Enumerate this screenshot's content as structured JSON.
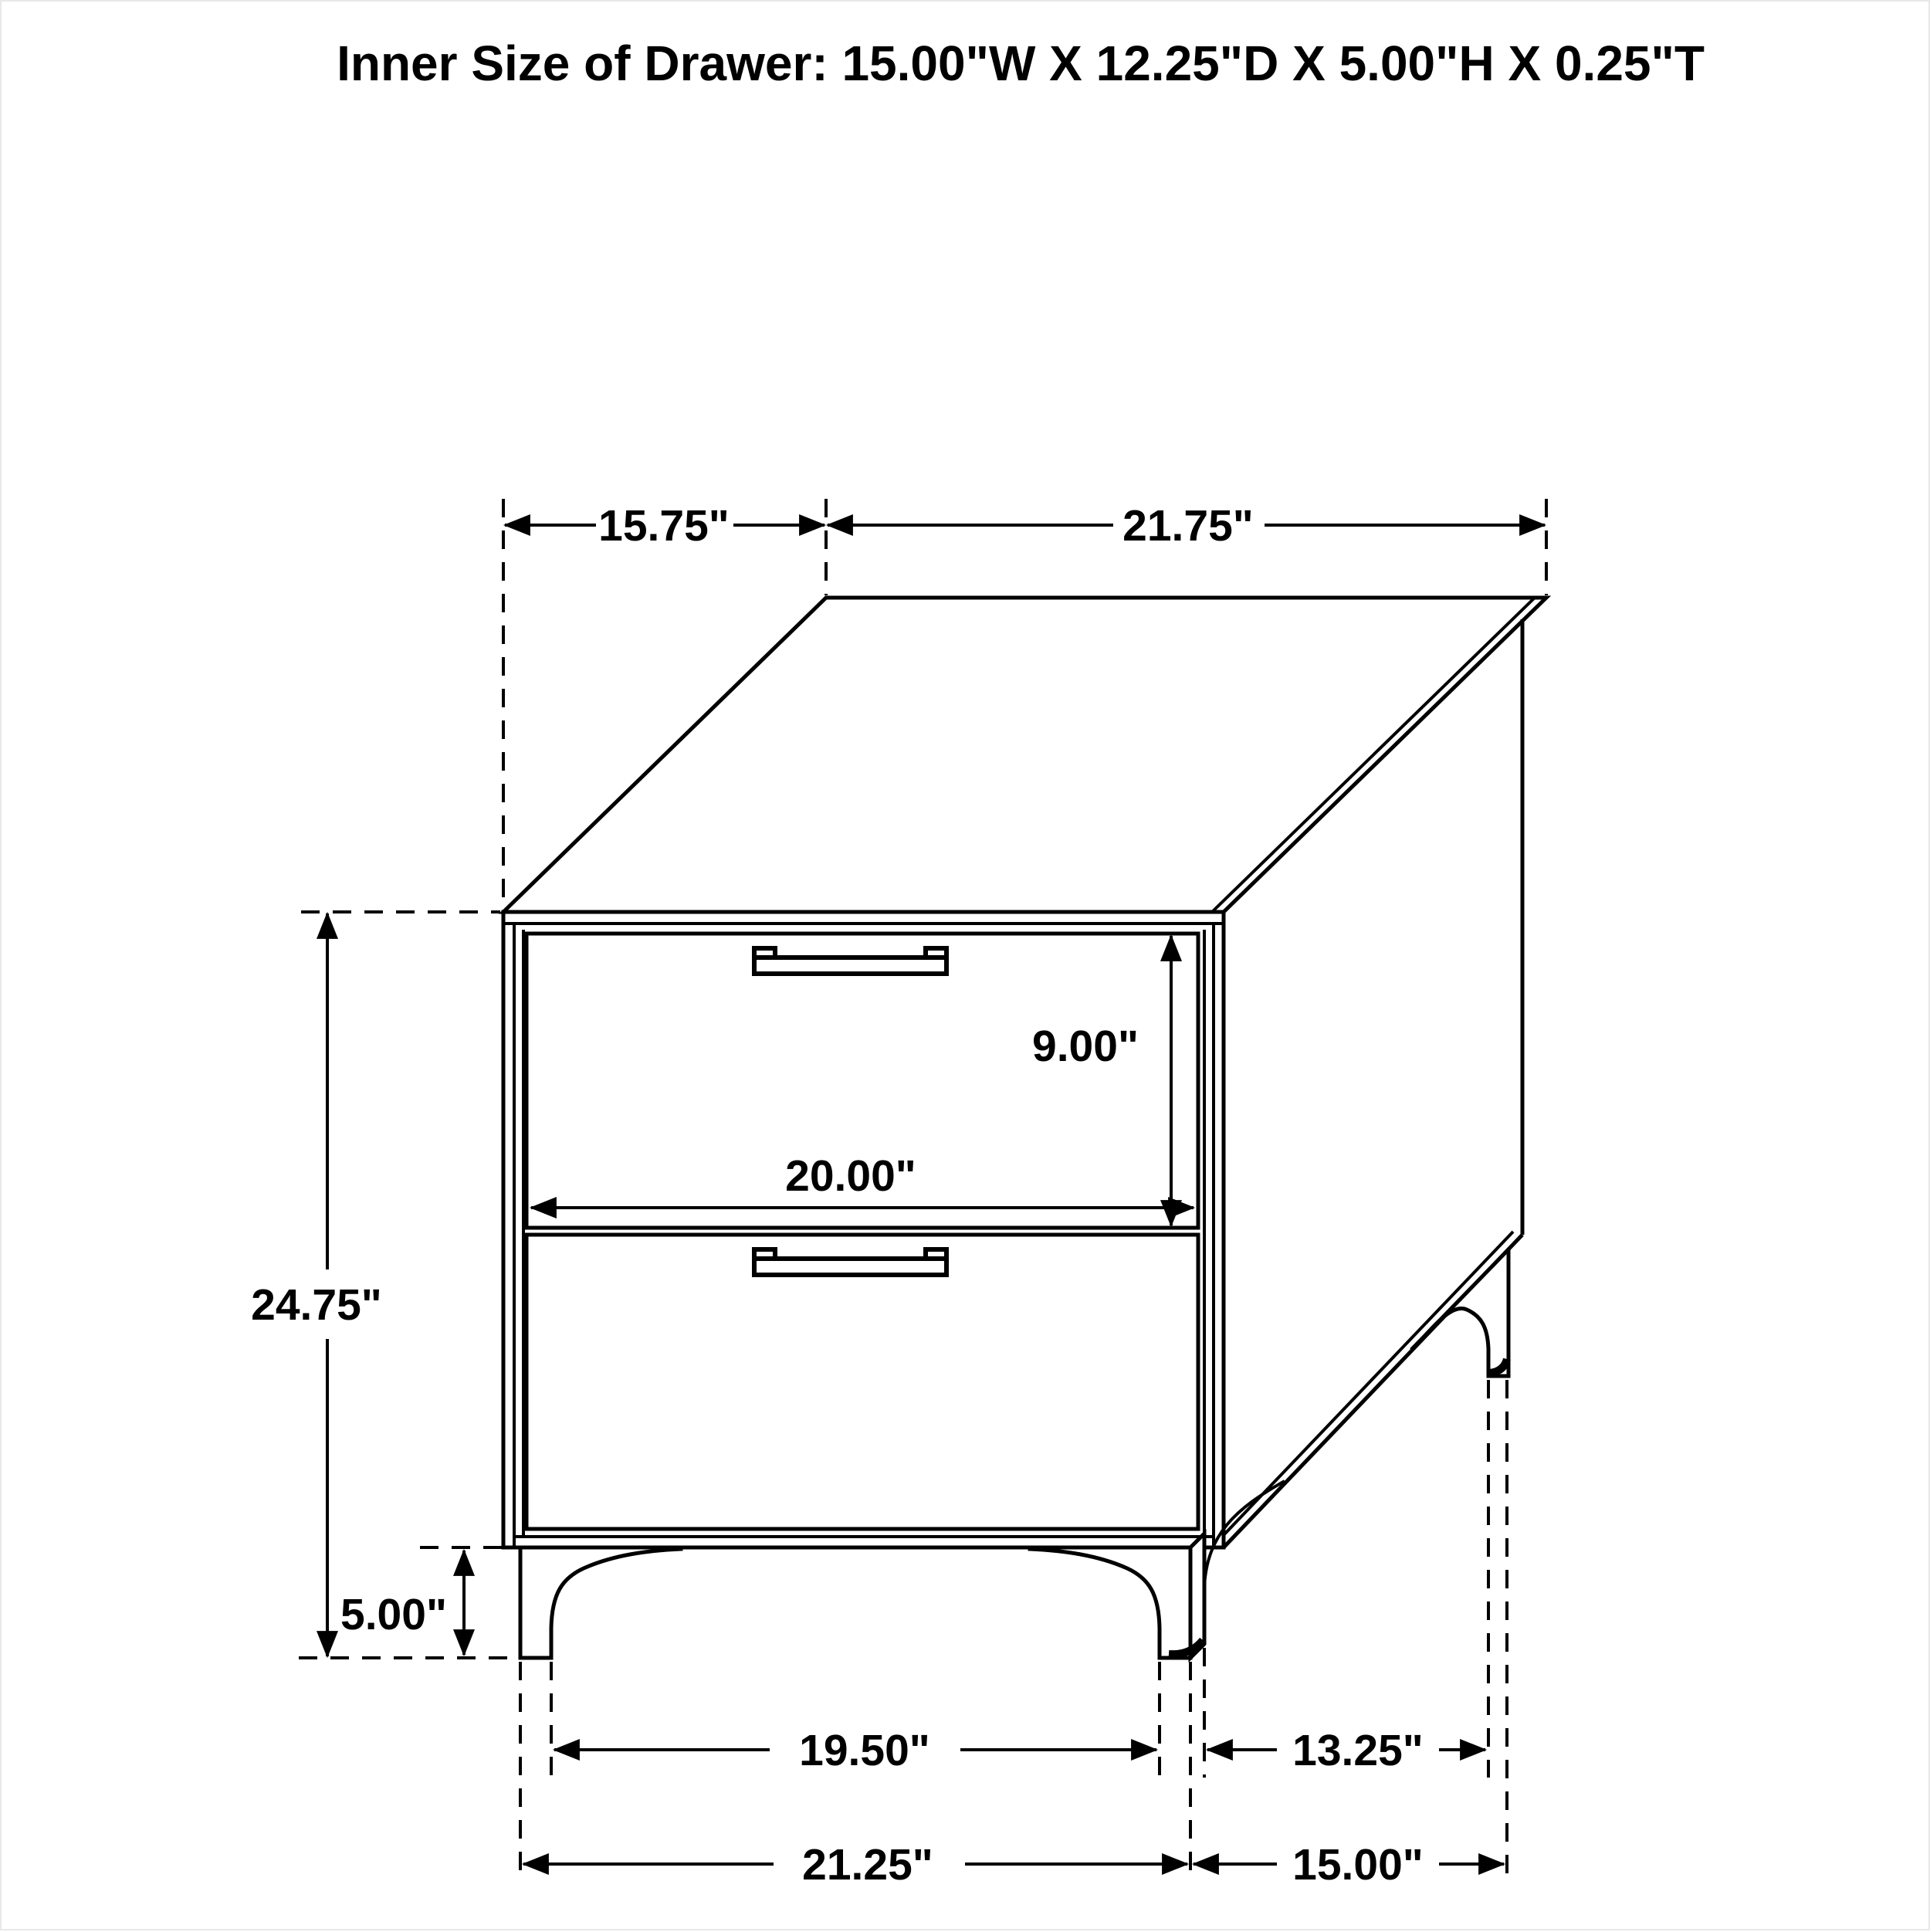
{
  "title": "Inner Size of Drawer: 15.00\"W X 12.25\"D X 5.00\"H X 0.25\"T",
  "dimensions": {
    "top_depth_label": "15.75\"",
    "top_width_label": "21.75\"",
    "overall_height_label": "24.75\"",
    "drawer_height_label": "9.00\"",
    "drawer_width_label": "20.00\"",
    "leg_height_label": "5.00\"",
    "front_legs_inner_label": "19.50\"",
    "legs_depth_inner_label": "13.25\"",
    "front_legs_outer_label": "21.25\"",
    "legs_depth_outer_label": "15.00\""
  }
}
